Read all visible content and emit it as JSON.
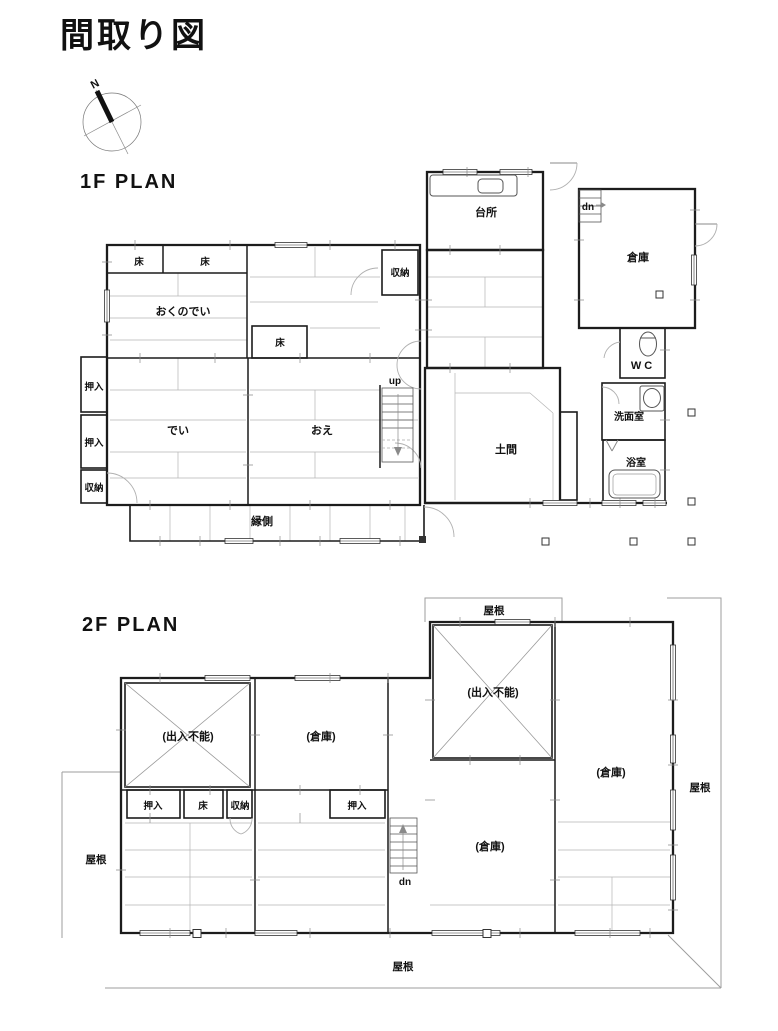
{
  "page": {
    "title": "間取り図"
  },
  "compass": {
    "north": "N"
  },
  "colors": {
    "ink": "#1c1c1c",
    "thin_line": "#9e9e9e"
  },
  "f1": {
    "heading": "1F PLAN",
    "labels": {
      "toko_a": "床",
      "toko_b": "床",
      "okunodei": "おくのでい",
      "toko_c": "床",
      "shunou_center": "収納",
      "daidokoro": "台所",
      "dn": "dn",
      "souko": "倉庫",
      "wc": "WC",
      "oshiire_a": "押入",
      "oshiire_b": "押入",
      "shunou_left": "収納",
      "dei": "でい",
      "oe": "おえ",
      "up": "up",
      "doma": "土間",
      "senmenshitsu": "洗面室",
      "yokushitsu": "浴室",
      "engawa": "縁側"
    }
  },
  "f2": {
    "heading": "2F PLAN",
    "labels": {
      "yane_top": "屋根",
      "yane_left": "屋根",
      "yane_right": "屋根",
      "yane_bottom": "屋根",
      "dennyu_funou_left": "(出入不能)",
      "souko_top": "(倉庫)",
      "dennyu_funou_right": "(出入不能)",
      "souko_right": "(倉庫)",
      "souko_center": "(倉庫)",
      "oshiire_a": "押入",
      "toko": "床",
      "shunou": "収納",
      "oshiire_b": "押入",
      "dn": "dn"
    }
  }
}
